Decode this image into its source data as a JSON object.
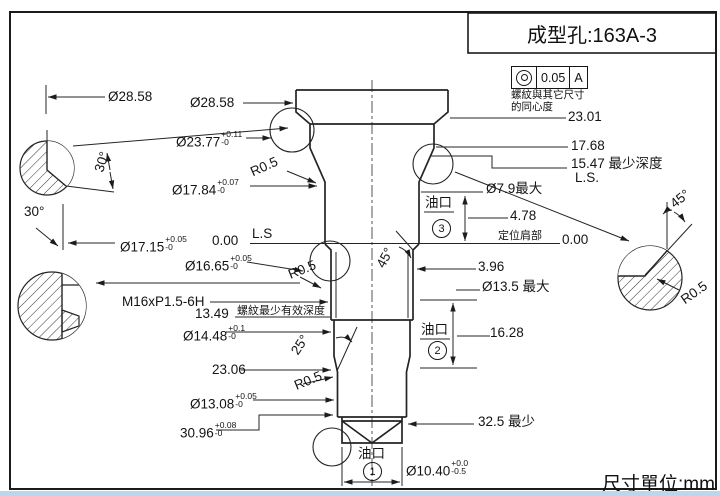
{
  "title_block": {
    "title": "成型孔:163A-3"
  },
  "tolerance_frame": {
    "value": "0.05",
    "datum": "A",
    "note_line1": "螺紋與其它尺寸",
    "note_line2": "的同心度"
  },
  "footer": {
    "unit": "尺寸單位:mm"
  },
  "dims": {
    "d2858a": "Ø28.58",
    "d2858b": "Ø28.58",
    "d2377": {
      "v": "Ø23.77",
      "up": "+0.11",
      "dn": "-0"
    },
    "d1784": {
      "v": "Ø17.84",
      "up": "+0.07",
      "dn": "-0"
    },
    "d1715": {
      "v": "Ø17.15",
      "up": "+0.05",
      "dn": "-0"
    },
    "d1665": {
      "v": "Ø16.65",
      "up": "+0.05",
      "dn": "-0"
    },
    "d1448": {
      "v": "Ø14.48",
      "up": "+0.1",
      "dn": "-0"
    },
    "d1308": {
      "v": "Ø13.08",
      "up": "+0.05",
      "dn": "-0"
    },
    "d3096": {
      "v": "30.96",
      "up": "+0.08",
      "dn": "-0"
    },
    "d1040": {
      "v": "Ø10.40",
      "up": "+0.0",
      "dn": "-0.5"
    },
    "r05": "R0.5",
    "a30": "30°",
    "a45": "45°",
    "a25": "25°",
    "zero": "0.00",
    "lsL": "L.S",
    "lsR": "L.S.",
    "thread": "M16xP1.5-6H",
    "thread_note": "螺紋最少有效深度",
    "d1349": "13.49",
    "d2306": "23.06",
    "e2301": "23.01",
    "e1768": "17.68",
    "e1547": "15.47 最少深度",
    "d79": "Ø7.9最大",
    "d478": "4.78",
    "datum_shoulder": "定位肩部",
    "d396": "3.96",
    "d135": "Ø13.5 最大",
    "d1628": "16.28",
    "min325": "32.5 最少",
    "port_label": "油口",
    "port1": "1",
    "port2": "2",
    "port3": "3"
  }
}
